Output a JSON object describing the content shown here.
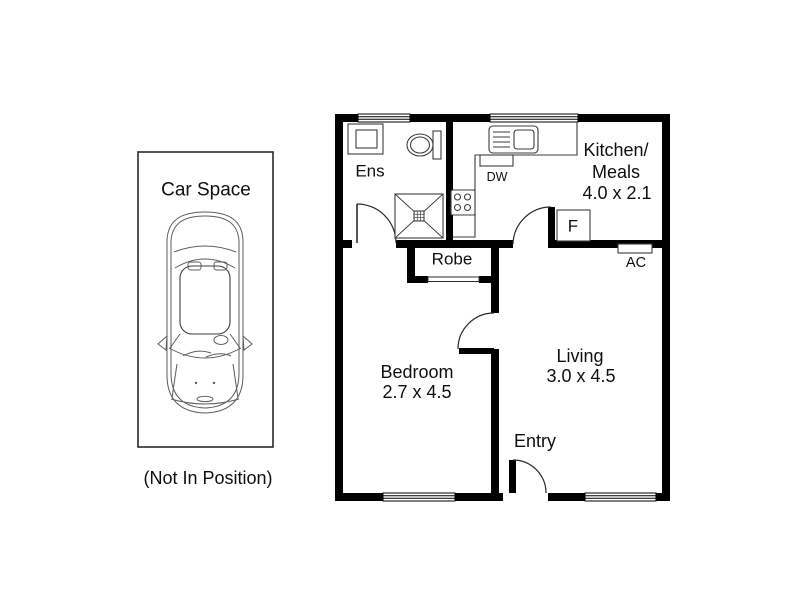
{
  "colors": {
    "wall": "#000000",
    "fixture_line": "#3d3d3d",
    "text": "#111111",
    "background": "#ffffff"
  },
  "car_space": {
    "title": "Car Space",
    "note": "(Not In Position)"
  },
  "rooms": {
    "ensuite": {
      "label": "Ens"
    },
    "kitchen_meals": {
      "line1": "Kitchen/",
      "line2": "Meals",
      "dims": "4.0 x 2.1"
    },
    "robe": {
      "label": "Robe"
    },
    "bedroom": {
      "label": "Bedroom",
      "dims": "2.7 x 4.5"
    },
    "living": {
      "label": "Living",
      "dims": "3.0 x 4.5"
    },
    "entry": {
      "label": "Entry"
    }
  },
  "fixtures": {
    "dishwasher": "DW",
    "fridge": "F",
    "air_conditioner": "AC"
  }
}
